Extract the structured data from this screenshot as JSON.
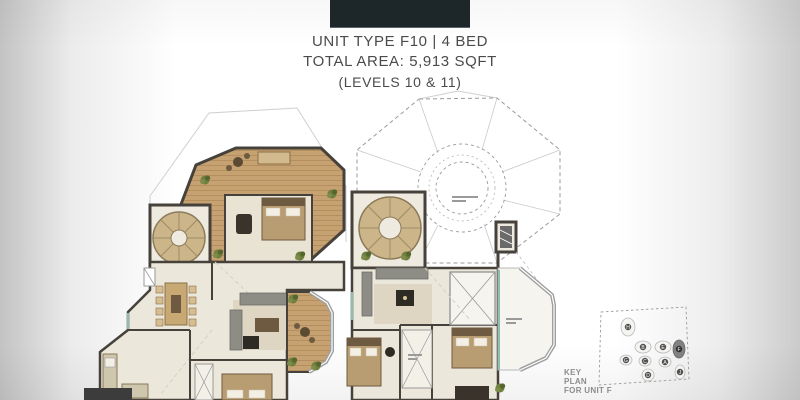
{
  "header": {
    "line1": "UNIT TYPE F10 | 4 BED",
    "line2": "TOTAL AREA: 5,913 SQFT",
    "line3": "(LEVELS 10 & 11)"
  },
  "key_plan": {
    "caption_lines": [
      "KEY",
      "PLAN",
      "FOR UNIT F"
    ],
    "highlighted_unit": "F",
    "buildings": [
      {
        "label": "H"
      },
      {
        "label": "B"
      },
      {
        "label": "E"
      },
      {
        "label": "F"
      },
      {
        "label": "G"
      },
      {
        "label": "C"
      },
      {
        "label": "A"
      },
      {
        "label": "D"
      },
      {
        "label": "J"
      }
    ]
  },
  "colors": {
    "logo_block": "#1d2629",
    "header_text": "#4b4b4b",
    "wall": "#46423b",
    "wood_deck": "#c6a171",
    "floor_cream": "#ece7db",
    "floor_beige": "#d8cdb4",
    "plant_green": "#6f7f3e",
    "glass_teal": "#8fbdb3",
    "keyplan_highlight": "#818181"
  }
}
